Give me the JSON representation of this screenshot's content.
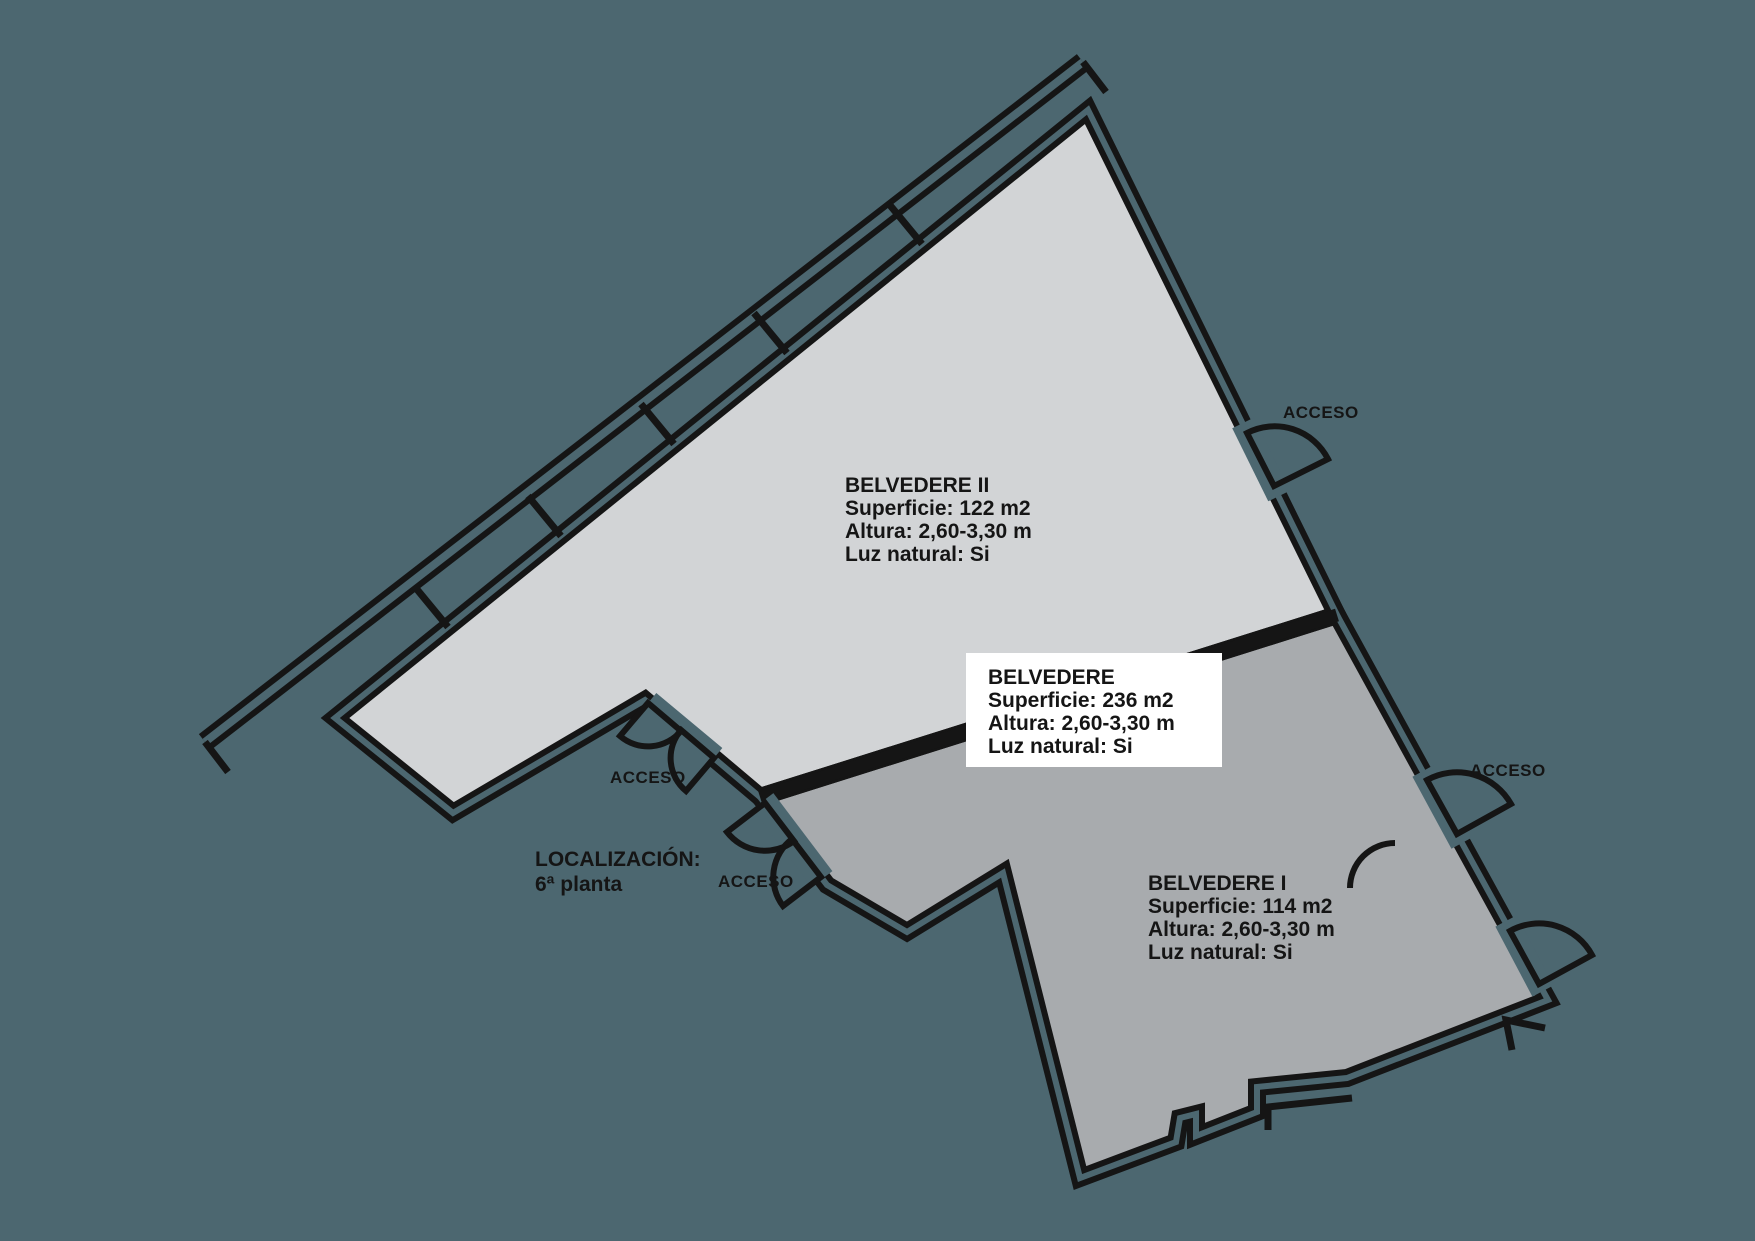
{
  "plan_title": "Belvedere floor plan",
  "colors": {
    "background": "#4C6770",
    "belvedere2_fill": "#D2D4D6",
    "belvedere1_fill": "#A8ABAE",
    "wall_ink": "#151515",
    "summary_box_bg": "#FFFFFF"
  },
  "summary_box": {
    "title": "BELVEDERE",
    "superficie": "Superficie: 236 m2",
    "altura": "Altura: 2,60-3,30 m",
    "luz": "Luz natural: Si"
  },
  "rooms": [
    {
      "id": "belvedere2",
      "title": "BELVEDERE II",
      "superficie": "Superficie: 122 m2",
      "altura": "Altura: 2,60-3,30 m",
      "luz": "Luz natural: Si"
    },
    {
      "id": "belvedere1",
      "title": "BELVEDERE I",
      "superficie": "Superficie: 114 m2",
      "altura": "Altura: 2,60-3,30 m",
      "luz": "Luz natural: Si"
    }
  ],
  "location": {
    "line1": "LOCALIZACIÓN:",
    "line2": "6ª planta"
  },
  "access": {
    "top_right": "ACCESO",
    "right_side": "ACCESO",
    "left_upper": "ACCESO",
    "left_lower": "ACCESO"
  }
}
